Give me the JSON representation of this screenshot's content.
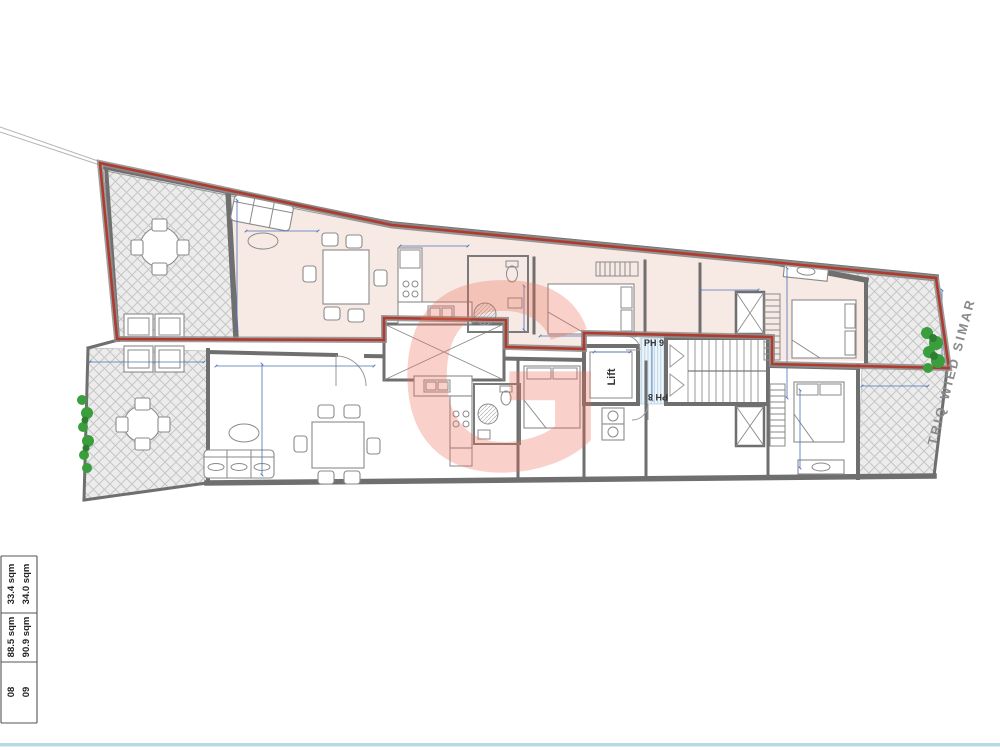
{
  "plan": {
    "labels": {
      "unit_top": "PH 9",
      "unit_bottom": "PH 8",
      "lift": "Lift",
      "street": "TRIQ WIED SIMAR",
      "watermark_letter": "G"
    },
    "area_table": {
      "rows": [
        {
          "unit": "08",
          "internal": "88.5 sqm",
          "external": "33.4 sqm"
        },
        {
          "unit": "09",
          "internal": "90.9 sqm",
          "external": "34.0 sqm"
        }
      ]
    },
    "colors": {
      "boundary_red": "#b03a2e",
      "wall_gray": "#6f6f6f",
      "dimension_blue": "#4a72b8",
      "interior_pink": "#f7eae5",
      "plant_green": "#3a9e3c",
      "footer_line_blue": "#b9d8e6"
    }
  }
}
